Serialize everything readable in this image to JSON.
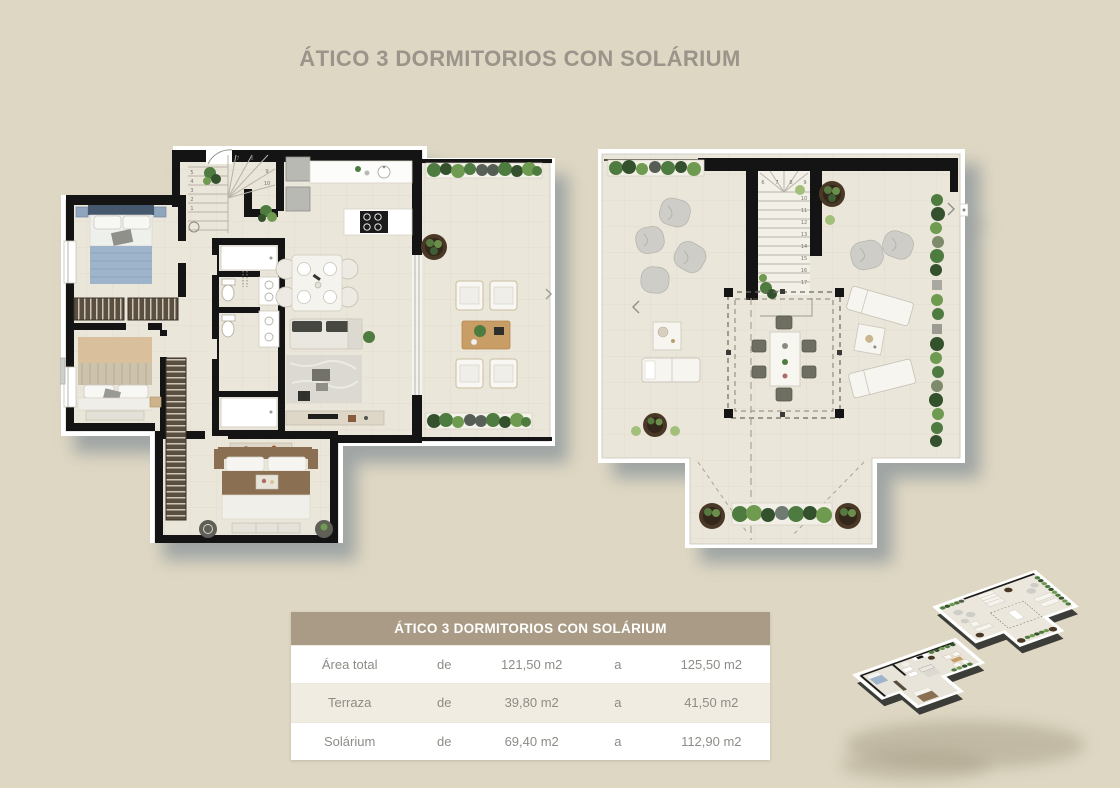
{
  "page": {
    "title": "ÁTICO 3 DORMITORIOS CON SOLÁRIUM",
    "background_color": "#ded7c3",
    "title_color": "#9a948a"
  },
  "table": {
    "title": "ÁTICO 3 DORMITORIOS CON SOLÁRIUM",
    "header_bg": "#a99b85",
    "rows": [
      {
        "label": "Área total",
        "from_word": "de",
        "from_value": "121,50 m2",
        "to_word": "a",
        "to_value": "125,50 m2"
      },
      {
        "label": "Terraza",
        "from_word": "de",
        "from_value": "39,80 m2",
        "to_word": "a",
        "to_value": "41,50 m2"
      },
      {
        "label": "Solárium",
        "from_word": "de",
        "from_value": "69,40 m2",
        "to_word": "a",
        "to_value": "112,90 m2"
      }
    ]
  },
  "plans": {
    "left": {
      "stairs_left_column": [
        "5",
        "4",
        "3",
        "2",
        "1"
      ],
      "stairs_top_row": [
        "7",
        "8"
      ],
      "stairs_right_column": [
        "9",
        "10"
      ]
    },
    "right": {
      "stairs_top_row": [
        "6",
        "7",
        "8",
        "9"
      ],
      "stairs_right_column": [
        "10",
        "11",
        "12",
        "13",
        "14",
        "15",
        "16",
        "17"
      ]
    }
  },
  "colors": {
    "wall": "#141414",
    "floor": "#ebe6da",
    "mat": "#ffffff",
    "shadow": "#6c7c8a",
    "plant_dark": "#32512c",
    "plant_mid": "#4e7b3f",
    "plant_light": "#6f9b50",
    "pot_brown": "#4a3827",
    "wood": "#c99d66",
    "bed_blue": "#9db4cb",
    "bed_tan": "#d9bf9b",
    "bed_brown": "#8a6f52"
  }
}
